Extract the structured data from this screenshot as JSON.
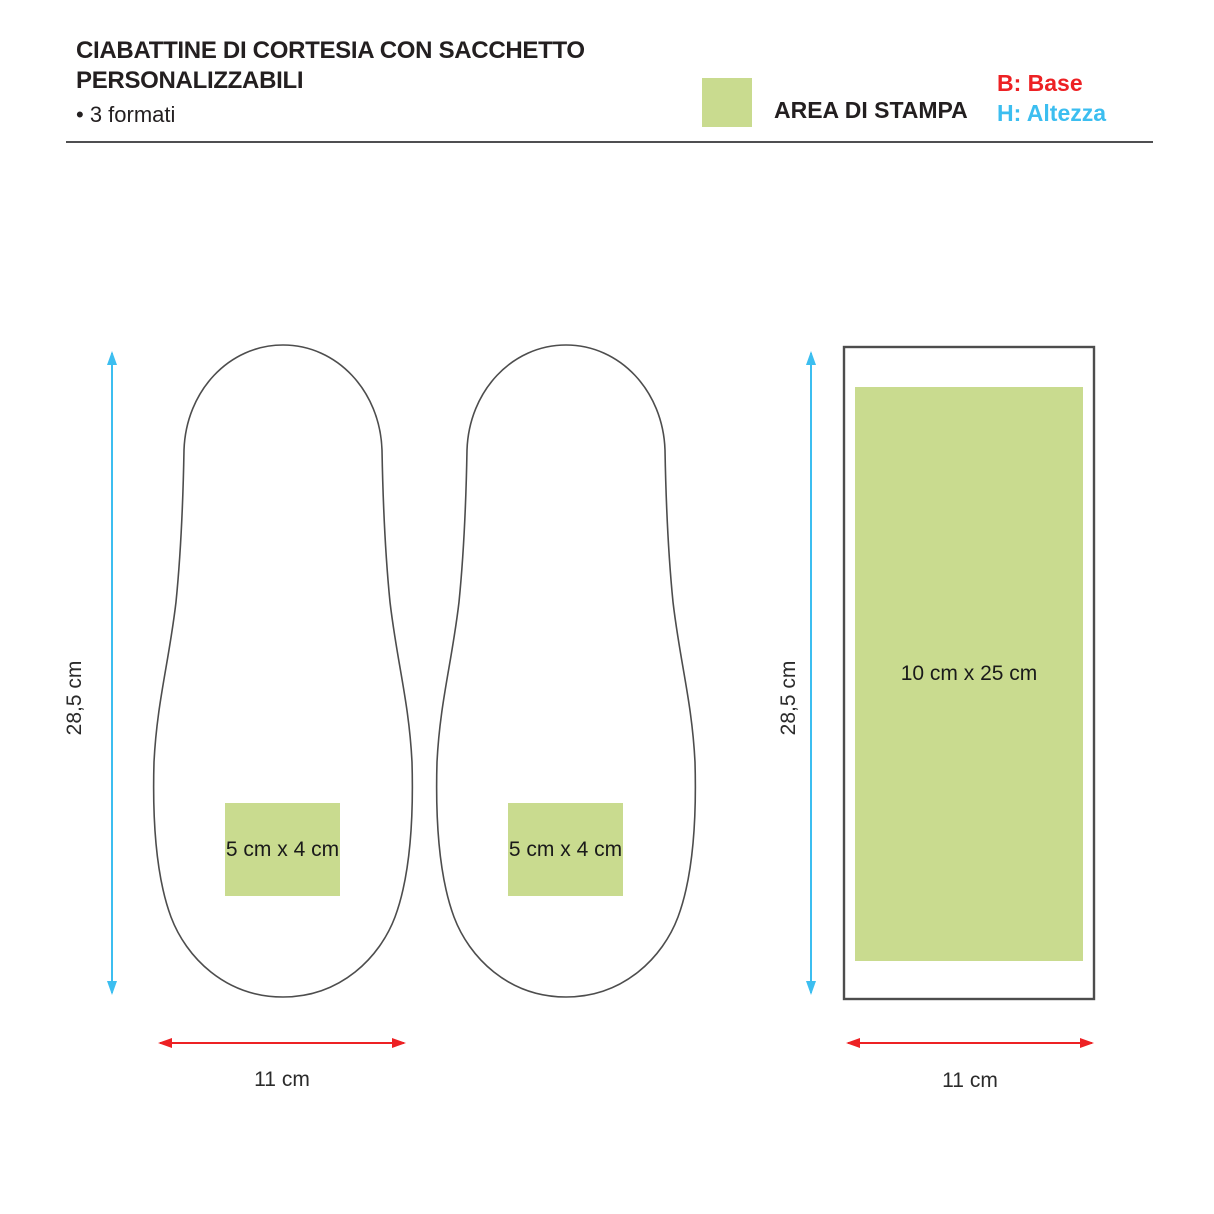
{
  "header": {
    "title_line1": "CIABATTINE DI CORTESIA CON SACCHETTO",
    "title_line2": "PERSONALIZZABILI",
    "subtitle": "• 3 formati",
    "legend": {
      "swatch": "print-area-green-swatch",
      "label": "AREA DI STAMPA"
    },
    "dimension_key": {
      "base": "B: Base",
      "height": "H: Altezza"
    }
  },
  "diagram": {
    "slippers": [
      {
        "name": "left-slipper",
        "print_area_label": "5 cm x 4 cm",
        "height_label": "28,5 cm",
        "width_label": "11 cm"
      },
      {
        "name": "center-slipper",
        "print_area_label": "5 cm x 4 cm"
      }
    ],
    "bag": {
      "name": "sacchetto",
      "print_area_label": "10 cm x 25 cm",
      "height_label": "28,5 cm",
      "width_label": "11 cm"
    },
    "colors": {
      "print_area_green": "#c9db8f",
      "width_arrow_red": "#ed2124",
      "height_arrow_cyan": "#3cbef0",
      "outline_gray": "#4d4d4d"
    }
  }
}
